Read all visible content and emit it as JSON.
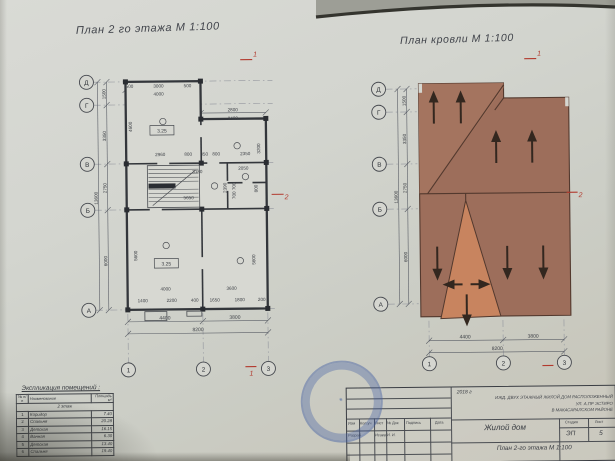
{
  "sheet": {
    "floor_plan": {
      "title": "План 2 го этажа М 1:100",
      "axes_rows": [
        "Д",
        "Г",
        "В",
        "Б",
        "А"
      ],
      "axes_cols": [
        "1",
        "2",
        "3"
      ],
      "elevation_upper": "3.25",
      "elevation_lower": "3.25",
      "section_mark_1": "1",
      "section_mark_2": "2",
      "dims": {
        "left_chain": [
          "1500",
          "3350",
          "2750",
          "6000"
        ],
        "left_total": "13600",
        "top_chain": [
          "500",
          "3000",
          "500"
        ],
        "top_total": "4000",
        "top_right": [
          "2800",
          "3400"
        ],
        "room_height_upper": "4600",
        "room_height_right": "3200",
        "mid_chain": [
          "2960",
          "800",
          "350",
          "800",
          "2350"
        ],
        "hall_width": "3180",
        "hall_length": "5650",
        "bath_width": "2050",
        "bath_depth": "2390",
        "bath_split": "700 700",
        "bath_side": "800",
        "room_w_left": "4000",
        "room_w_right": "3600",
        "room_h_left": "5600",
        "room_h_right": "5600",
        "bottom_chain": [
          "1400",
          "2200",
          "400",
          "1650",
          "1800",
          "200"
        ],
        "bottom_spans": [
          "4400",
          "3800"
        ],
        "bottom_total": "8200"
      }
    },
    "roof_plan": {
      "title": "План кровли М 1:100",
      "axes_rows": [
        "Д",
        "Г",
        "В",
        "Б",
        "А"
      ],
      "axes_cols": [
        "1",
        "2",
        "3"
      ],
      "section_mark_1": "1",
      "section_mark_2": "2",
      "dims": {
        "left_chain": [
          "1500",
          "3350",
          "2750",
          "6000"
        ],
        "left_total": "13600",
        "bottom_spans": [
          "4400",
          "3800"
        ],
        "bottom_total": "8200"
      }
    },
    "room_table": {
      "title": "Экспликация помещений :",
      "headers": [
        "№ п/п",
        "Наименование",
        "Площадь м²"
      ],
      "section": "2 этаж",
      "rows": [
        [
          "1",
          "Коридор",
          "7.40"
        ],
        [
          "2",
          "Спальня",
          "20.28"
        ],
        [
          "3",
          "Детская",
          "16.15"
        ],
        [
          "4",
          "Ванная",
          "6.30"
        ],
        [
          "5",
          "Детская",
          "13.40"
        ],
        [
          "6",
          "Спальня",
          "19.40"
        ]
      ]
    },
    "title_block": {
      "year": "2018 г",
      "project_line1": "ИЖД. ДВУХ ЭТАЖНЫЙ ЖИЛОЙ ДОМ РАСПОЛОЖЕННЫЙ",
      "project_line2": "УЛ. А.ПР ЭСТИРО",
      "project_line3": "В МАКАСАРАЛСКОМ РАЙОНЕ",
      "col_headers": [
        "Изм",
        "Кол.уч",
        "Лист",
        "№ Док",
        "Подпись",
        "Дата"
      ],
      "row_label": "Разраб",
      "row_value": "Исаев И. И.",
      "object_name": "Жилой дом",
      "stage_label": "Стадия",
      "sheet_label": "Лист",
      "stage_value": "ЭП",
      "sheet_value": "5",
      "drawing_name": "План 2-го этажа М 1:100"
    }
  },
  "colors": {
    "roof_main": "#9d6e5b",
    "roof_light": "#c8845f",
    "roof_line": "#53392e",
    "red_mark": "#b23a2e"
  }
}
